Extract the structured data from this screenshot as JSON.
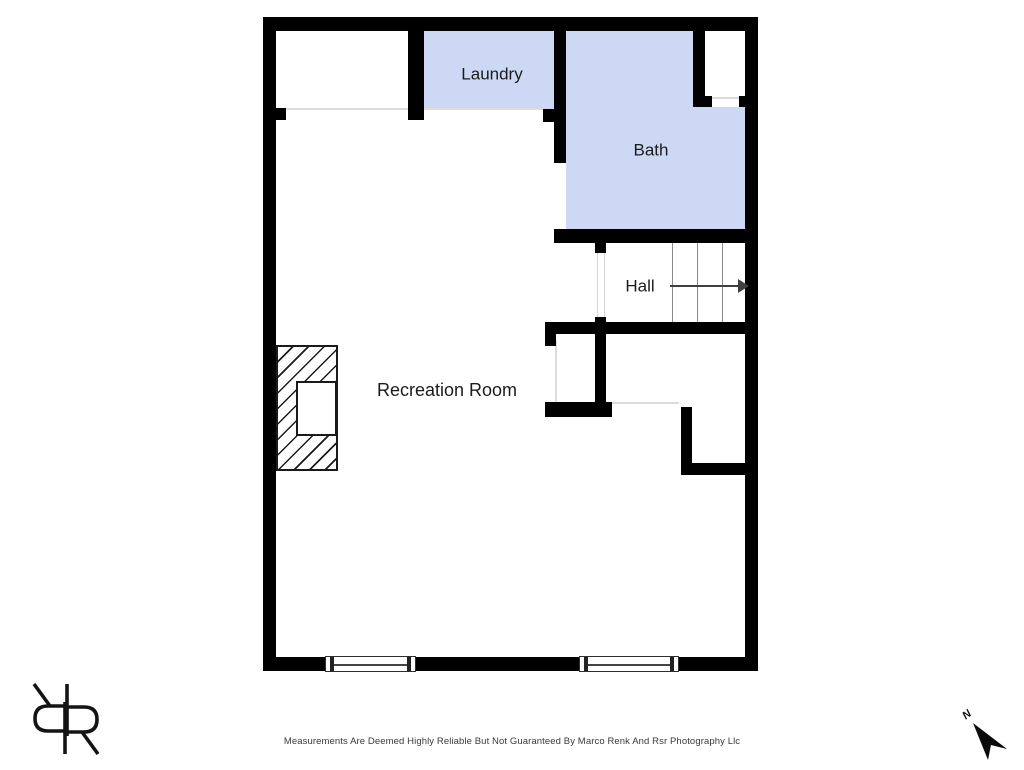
{
  "rooms": {
    "laundry": {
      "label": "Laundry"
    },
    "bath": {
      "label": "Bath"
    },
    "hall": {
      "label": "Hall"
    },
    "recreation": {
      "label": "Recreation Room"
    }
  },
  "footer": {
    "disclaimer": "Measurements Are Deemed Highly Reliable But Not Guaranteed By Marco Renk And Rsr Photography Llc"
  },
  "compass": {
    "label": "N"
  },
  "icons": {
    "logo": "rr-monogram",
    "north": "north-arrow-icon",
    "stairs": "stair-direction-arrow"
  },
  "colors": {
    "room_fill": "#cdd9f4",
    "wall": "#000000",
    "label_text": "#1b1b1b",
    "stair_line": "#8a8a8a",
    "arrow": "#3f3f3f",
    "opening_line": "#dcdcdc",
    "footer_text": "#3a3a3a"
  }
}
